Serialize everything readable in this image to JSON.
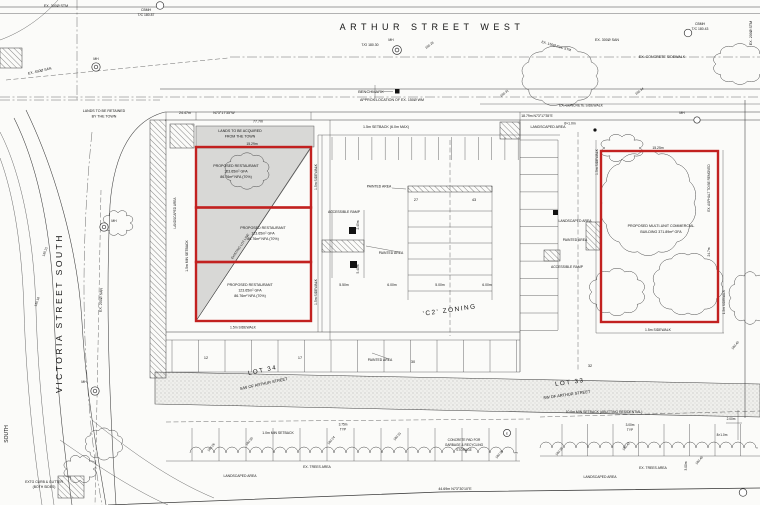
{
  "colors": {
    "building_outline": "#c22120",
    "lands_shading": "#d8d8d6",
    "linework": "#3d3d3d",
    "paper": "#fbfbf9"
  },
  "annotations": [
    {
      "name": "ex-300-stm-label",
      "text": "EX. 300Ø STM",
      "x": 56,
      "y": 7,
      "size": 3.6
    },
    {
      "name": "cbmh-nw-label",
      "text": "CBMH",
      "x": 146,
      "y": 11,
      "size": 3.4
    },
    {
      "name": "cbmh-nw-elev",
      "text": "T/C 180.87",
      "x": 146,
      "y": 16,
      "size": 3.4
    },
    {
      "name": "arthur-street-name",
      "text": "ARTHUR STREET WEST",
      "x": 432,
      "y": 30,
      "size": 9,
      "ls": 4.5
    },
    {
      "name": "mh-arthur-label",
      "text": "MH",
      "x": 391,
      "y": 41,
      "size": 3.4
    },
    {
      "name": "mh-arthur-elev",
      "text": "T/O 180.30",
      "x": 370,
      "y": 46,
      "size": 3.4
    },
    {
      "name": "spot-elev-1",
      "text": "180.28",
      "x": 430,
      "y": 46,
      "rot": -38,
      "size": 3.2
    },
    {
      "name": "ex-300-san-label",
      "text": "EX. 300Ø SAN",
      "x": 607,
      "y": 41,
      "size": 3.6
    },
    {
      "name": "ex-150-pvc-stm-label",
      "text": "EX. 150Ø PVC STM",
      "x": 556,
      "y": 47,
      "rot": 16,
      "size": 3.4
    },
    {
      "name": "cbmh-ne-label",
      "text": "CBMH",
      "x": 700,
      "y": 25,
      "size": 3.4
    },
    {
      "name": "cbmh-ne-elev",
      "text": "T/C 180.43",
      "x": 700,
      "y": 30,
      "size": 3.4
    },
    {
      "name": "ex-200-stm-label",
      "text": "EX. 200Ø STM",
      "x": 752,
      "y": 33,
      "rot": -90,
      "size": 3.6
    },
    {
      "name": "ex-concrete-sidewalk-ne",
      "text": "EX. CONCRETE SIDEWALK",
      "x": 662,
      "y": 58,
      "size": 3.6
    },
    {
      "name": "spot-elev-2",
      "text": "180.31",
      "x": 505,
      "y": 94,
      "rot": -38,
      "size": 3.2
    },
    {
      "name": "spot-elev-3",
      "text": "180.34",
      "x": 640,
      "y": 92,
      "rot": -38,
      "size": 3.2
    },
    {
      "name": "benchmark-label",
      "text": "BENCHMARK",
      "x": 371,
      "y": 93,
      "size": 4
    },
    {
      "name": "approx-wm-label",
      "text": "APPROX LOCATION OF EX. 150Ø WM",
      "x": 392,
      "y": 101,
      "size": 3.6
    },
    {
      "name": "lands-retained-1",
      "text": "LANDS TO BE RETAINED",
      "x": 104,
      "y": 112,
      "size": 3.6
    },
    {
      "name": "lands-retained-2",
      "text": "BY THE TOWN",
      "x": 104,
      "y": 117.5,
      "size": 3.6
    },
    {
      "name": "ex-450-san-label",
      "text": "EX. 450Ø SAN",
      "x": 40,
      "y": 72,
      "rot": -13,
      "size": 3.6
    },
    {
      "name": "mh-nw-label",
      "text": "MH",
      "x": 96,
      "y": 60,
      "size": 3.4
    },
    {
      "name": "dim-2447",
      "text": "24.47m",
      "x": 185,
      "y": 114,
      "size": 3.6
    },
    {
      "name": "bearing-nw",
      "text": "N73°17'35\"W",
      "x": 224,
      "y": 114,
      "size": 3.6
    },
    {
      "name": "dim-777",
      "text": "77.7m",
      "x": 258,
      "y": 122.5,
      "size": 3.6
    },
    {
      "name": "setback-top-label",
      "text": "1.5m SETBACK (6.0m MAX)",
      "x": 386,
      "y": 128,
      "size": 3.6
    },
    {
      "name": "landscaped-top-label",
      "text": "LANDSCAPED AREA",
      "x": 548,
      "y": 128,
      "size": 3.6
    },
    {
      "name": "dim-1879",
      "text": "18.79m  N73°17'35\"E",
      "x": 537,
      "y": 117,
      "size": 3.4
    },
    {
      "name": "sidewalk-6x1",
      "text": "6×1.0m",
      "x": 570,
      "y": 124.5,
      "size": 3.4
    },
    {
      "name": "ex-concrete-sidewalk-e",
      "text": "EX. CONCRETE SIDEWALK",
      "x": 581,
      "y": 106.5,
      "size": 3.4
    },
    {
      "name": "mh-e-label",
      "text": "MH",
      "x": 682,
      "y": 114,
      "size": 3.4
    },
    {
      "name": "lands-acquired-1",
      "text": "LANDS TO BE ACQUIRED",
      "x": 240,
      "y": 132,
      "size": 3.6
    },
    {
      "name": "lands-acquired-2",
      "text": "FROM THE TOWN",
      "x": 240,
      "y": 137.5,
      "size": 3.6
    },
    {
      "name": "dim-1529",
      "text": "15.29m",
      "x": 252,
      "y": 145,
      "size": 3.4
    },
    {
      "name": "restaurant1-line1",
      "text": "PROPOSED RESTAURANT",
      "x": 236,
      "y": 167,
      "size": 3.6
    },
    {
      "name": "restaurant1-line2",
      "text": "123.65m² GFA",
      "x": 236,
      "y": 172.5,
      "size": 3.6
    },
    {
      "name": "restaurant1-line3",
      "text": "86.76m² NFA (70%)",
      "x": 236,
      "y": 178,
      "size": 3.6
    },
    {
      "name": "restaurant2-line1",
      "text": "PROPOSED RESTAURANT",
      "x": 263,
      "y": 229,
      "size": 3.6
    },
    {
      "name": "restaurant2-line2",
      "text": "123.65m² GFA",
      "x": 263,
      "y": 234.5,
      "size": 3.6
    },
    {
      "name": "restaurant2-line3",
      "text": "86.76m² NFA (70%)",
      "x": 263,
      "y": 240,
      "size": 3.6
    },
    {
      "name": "restaurant3-line1",
      "text": "PROPOSED RESTAURANT",
      "x": 250,
      "y": 286,
      "size": 3.6
    },
    {
      "name": "restaurant3-line2",
      "text": "123.65m² GFA",
      "x": 250,
      "y": 291.5,
      "size": 3.6
    },
    {
      "name": "restaurant3-line3",
      "text": "86.76m² NFA (70%)",
      "x": 250,
      "y": 297,
      "size": 3.6
    },
    {
      "name": "existing-lot-line-label",
      "text": "EXISTING LOT LINE",
      "x": 241,
      "y": 247,
      "rot": -56,
      "size": 3.2
    },
    {
      "name": "sidewalk-left-v1",
      "text": "1.5m SIDEWALK",
      "x": 317,
      "y": 177,
      "rot": -90,
      "size": 3.4
    },
    {
      "name": "sidewalk-left-v2",
      "text": "1.5m SIDEWALK",
      "x": 317,
      "y": 292,
      "rot": -90,
      "size": 3.4
    },
    {
      "name": "sidewalk-left-bottom",
      "text": "1.5m SIDEWALK",
      "x": 243,
      "y": 328.5,
      "size": 3.4
    },
    {
      "name": "setback-left-v",
      "text": "1.5m MIN SETBACK",
      "x": 188,
      "y": 256,
      "rot": -90,
      "size": 3.4
    },
    {
      "name": "landscaped-left-v",
      "text": "LANDSCAPED AREA",
      "x": 176,
      "y": 213,
      "rot": -90,
      "size": 3.2
    },
    {
      "name": "victoria-street-name",
      "text": "VICTORIA STREET SOUTH",
      "x": 62,
      "y": 313,
      "rot": -90,
      "size": 8.5,
      "ls": 2.5
    },
    {
      "name": "ex-200-san-label",
      "text": "EX. 200Ø SAN",
      "x": 102,
      "y": 300,
      "rot": -88,
      "size": 3.6
    },
    {
      "name": "mh-v1-label",
      "text": "MH",
      "x": 114,
      "y": 222,
      "size": 3.4
    },
    {
      "name": "mh-v2-label",
      "text": "MH",
      "x": 84,
      "y": 383,
      "size": 3.4
    },
    {
      "name": "south-street-label",
      "text": "SOUTH",
      "x": 8,
      "y": 434,
      "rot": -90,
      "size": 5
    },
    {
      "name": "painted-area-1",
      "text": "PAINTED AREA",
      "x": 379,
      "y": 187.5,
      "size": 3.4
    },
    {
      "name": "stall-count-27",
      "text": "27",
      "x": 416,
      "y": 201,
      "size": 3.8
    },
    {
      "name": "stall-count-43",
      "text": "43",
      "x": 474,
      "y": 201,
      "size": 3.8
    },
    {
      "name": "accessible-ramp-1",
      "text": "ACCESSIBLE RAMP",
      "x": 344,
      "y": 213,
      "size": 3.4
    },
    {
      "name": "dim-245",
      "text": "2.45m",
      "x": 359,
      "y": 225,
      "rot": -90,
      "size": 3.2
    },
    {
      "name": "painted-area-2",
      "text": "PAINTED AREA",
      "x": 391,
      "y": 254,
      "size": 3.4
    },
    {
      "name": "dim-540",
      "text": "5.40m",
      "x": 359,
      "y": 269,
      "rot": -90,
      "size": 3.2
    },
    {
      "name": "dim-550",
      "text": "5.50m",
      "x": 344,
      "y": 286,
      "size": 3.4
    },
    {
      "name": "dim-600a",
      "text": "6.00m",
      "x": 392,
      "y": 286,
      "size": 3.4
    },
    {
      "name": "dim-500",
      "text": "5.00m",
      "x": 440,
      "y": 286,
      "size": 3.4
    },
    {
      "name": "dim-600b",
      "text": "6.00m",
      "x": 487,
      "y": 286,
      "size": 3.4
    },
    {
      "name": "c2-zoning-label",
      "text": "'C2' ZONING",
      "x": 450,
      "y": 312,
      "rot": -8,
      "size": 6.5,
      "ls": 1.5
    },
    {
      "name": "stall-count-12",
      "text": "12",
      "x": 206,
      "y": 359,
      "size": 3.8
    },
    {
      "name": "stall-count-17",
      "text": "17",
      "x": 300,
      "y": 359,
      "size": 3.8
    },
    {
      "name": "stall-count-30",
      "text": "30",
      "x": 413,
      "y": 363,
      "size": 3.8
    },
    {
      "name": "stall-count-32",
      "text": "32",
      "x": 590,
      "y": 367,
      "size": 3.8
    },
    {
      "name": "painted-area-3",
      "text": "PAINTED AREA",
      "x": 380,
      "y": 361,
      "size": 3.4
    },
    {
      "name": "lot34-label",
      "text": "LOT 34",
      "x": 263,
      "y": 372,
      "rot": -12,
      "size": 6.2,
      "ls": 1.5
    },
    {
      "name": "lot34-sub",
      "text": "S/W OF ARTHUR STREET",
      "x": 264,
      "y": 385,
      "rot": -12,
      "size": 4
    },
    {
      "name": "lot33-label",
      "text": "LOT 33",
      "x": 570,
      "y": 384,
      "rot": -8,
      "size": 6.2,
      "ls": 1.5
    },
    {
      "name": "lot33-sub",
      "text": "SW OF ARTHUR STREET",
      "x": 567,
      "y": 396,
      "rot": -8,
      "size": 4
    },
    {
      "name": "landscaped-mid",
      "text": "LANDSCAPED AREA",
      "x": 575,
      "y": 222,
      "size": 3.4
    },
    {
      "name": "painted-area-4",
      "text": "PAINTED AREA",
      "x": 575,
      "y": 241,
      "size": 3.4
    },
    {
      "name": "accessible-ramp-2",
      "text": "ACCESSIBLE RAMP",
      "x": 567,
      "y": 268,
      "size": 3.4
    },
    {
      "name": "commercial-line1",
      "text": "PROPOSED MULTI-UNIT COMMERCIAL",
      "x": 661,
      "y": 227,
      "size": 3.6
    },
    {
      "name": "commercial-line2",
      "text": "BUILDING 371.89m² GFA",
      "x": 661,
      "y": 233,
      "size": 3.6
    },
    {
      "name": "dim-1525",
      "text": "15.25m",
      "x": 658,
      "y": 149,
      "size": 3.4
    },
    {
      "name": "sidewalk-right-v1",
      "text": "1.5m SIDEWALK",
      "x": 598,
      "y": 162,
      "rot": -90,
      "size": 3.4
    },
    {
      "name": "sidewalk-right-bottom",
      "text": "1.5m SIDEWALK",
      "x": 658,
      "y": 331,
      "size": 3.4
    },
    {
      "name": "asphalt-removed-label",
      "text": "EX. ASPHALT TO BE REMOVED",
      "x": 710,
      "y": 188,
      "rot": -90,
      "size": 3.2
    },
    {
      "name": "dim-247",
      "text": "24.7m",
      "x": 710,
      "y": 252,
      "rot": -90,
      "size": 3.2
    },
    {
      "name": "sidewalk-right-v2",
      "text": "1.5m SIDEWALK",
      "x": 725,
      "y": 302,
      "rot": -90,
      "size": 3.2
    },
    {
      "name": "setback-rear-left",
      "text": "1.0m MIN SETBACK",
      "x": 278,
      "y": 434,
      "size": 3.4
    },
    {
      "name": "dim-375-left-a",
      "text": "3.75m",
      "x": 343,
      "y": 425.5,
      "size": 3.2
    },
    {
      "name": "dim-375-left-b",
      "text": "TYP",
      "x": 343,
      "y": 430.5,
      "size": 3.2
    },
    {
      "name": "ex-trees-left",
      "text": "EX. TREES AREA",
      "x": 317,
      "y": 468,
      "size": 3.4
    },
    {
      "name": "landscaped-bottom-left",
      "text": "LANDSCAPED AREA",
      "x": 240,
      "y": 477,
      "size": 3.4
    },
    {
      "name": "setback-rear-right",
      "text": "10.0m MIN SETBACK (ABUTTING RESIDENTIAL)",
      "x": 604,
      "y": 413,
      "size": 3.4
    },
    {
      "name": "concrete-pad-1",
      "text": "CONCRETE PAD FOR",
      "x": 464,
      "y": 441,
      "size": 3.2
    },
    {
      "name": "concrete-pad-2",
      "text": "GARBAGE & RECYCLING",
      "x": 464,
      "y": 446,
      "size": 3.2
    },
    {
      "name": "concrete-pad-3",
      "text": "STORAGE",
      "x": 464,
      "y": 451,
      "size": 3.2
    },
    {
      "name": "detail-bubble-e",
      "text": "E",
      "x": 507,
      "y": 434.3,
      "size": 3
    },
    {
      "name": "dim-300-typ-a",
      "text": "3.00m",
      "x": 630,
      "y": 426,
      "size": 3.2
    },
    {
      "name": "dim-300-typ-b",
      "text": "TYP",
      "x": 630,
      "y": 431,
      "size": 3.2
    },
    {
      "name": "ex-trees-right",
      "text": "EX. TREES AREA",
      "x": 653,
      "y": 469,
      "size": 3.4
    },
    {
      "name": "landscaped-bottom-right",
      "text": "LANDSCAPED AREA",
      "x": 600,
      "y": 478,
      "size": 3.4
    },
    {
      "name": "dim-300-v",
      "text": "3.00m",
      "x": 687,
      "y": 466,
      "rot": -90,
      "size": 3.2
    },
    {
      "name": "dim-200",
      "text": "2.00m",
      "x": 731,
      "y": 420,
      "size": 3.2
    },
    {
      "name": "dim-8x1",
      "text": "8×1.0m",
      "x": 722,
      "y": 436,
      "size": 3.2
    },
    {
      "name": "bearing-south",
      "text": "44.69m  N73°30'10\"E",
      "x": 455,
      "y": 490,
      "size": 3.6
    },
    {
      "name": "curb-gutter-1",
      "text": "EXTG CURB & GUTTER",
      "x": 44,
      "y": 483,
      "size": 3.4
    },
    {
      "name": "curb-gutter-2",
      "text": "(BOTH SIDES)",
      "x": 44,
      "y": 488,
      "size": 3.4
    },
    {
      "name": "spot-elev-4",
      "text": "180.26",
      "x": 212,
      "y": 448,
      "rot": -50,
      "size": 3.2
    },
    {
      "name": "spot-elev-5",
      "text": "180.30",
      "x": 250,
      "y": 442,
      "rot": -50,
      "size": 3.2
    },
    {
      "name": "spot-elev-6",
      "text": "180.24",
      "x": 332,
      "y": 441,
      "rot": -50,
      "size": 3.2
    },
    {
      "name": "spot-elev-7",
      "text": "180.31",
      "x": 398,
      "y": 437,
      "rot": -50,
      "size": 3.2
    },
    {
      "name": "spot-elev-8",
      "text": "180.28",
      "x": 500,
      "y": 455,
      "rot": -50,
      "size": 3.2
    },
    {
      "name": "spot-elev-9",
      "text": "180.35",
      "x": 560,
      "y": 452,
      "rot": -50,
      "size": 3.2
    },
    {
      "name": "spot-elev-10",
      "text": "180.42",
      "x": 627,
      "y": 447,
      "rot": -50,
      "size": 3.2
    },
    {
      "name": "spot-elev-11",
      "text": "180.45",
      "x": 700,
      "y": 461,
      "rot": -50,
      "size": 3.2
    },
    {
      "name": "spot-elev-12",
      "text": "180.40",
      "x": 736,
      "y": 346,
      "rot": -50,
      "size": 3.2
    },
    {
      "name": "spot-elev-13",
      "text": "180.21",
      "x": 46,
      "y": 252,
      "rot": -70,
      "size": 3.2
    },
    {
      "name": "spot-elev-14",
      "text": "180.18",
      "x": 38,
      "y": 302,
      "rot": -70,
      "size": 3.2
    }
  ]
}
